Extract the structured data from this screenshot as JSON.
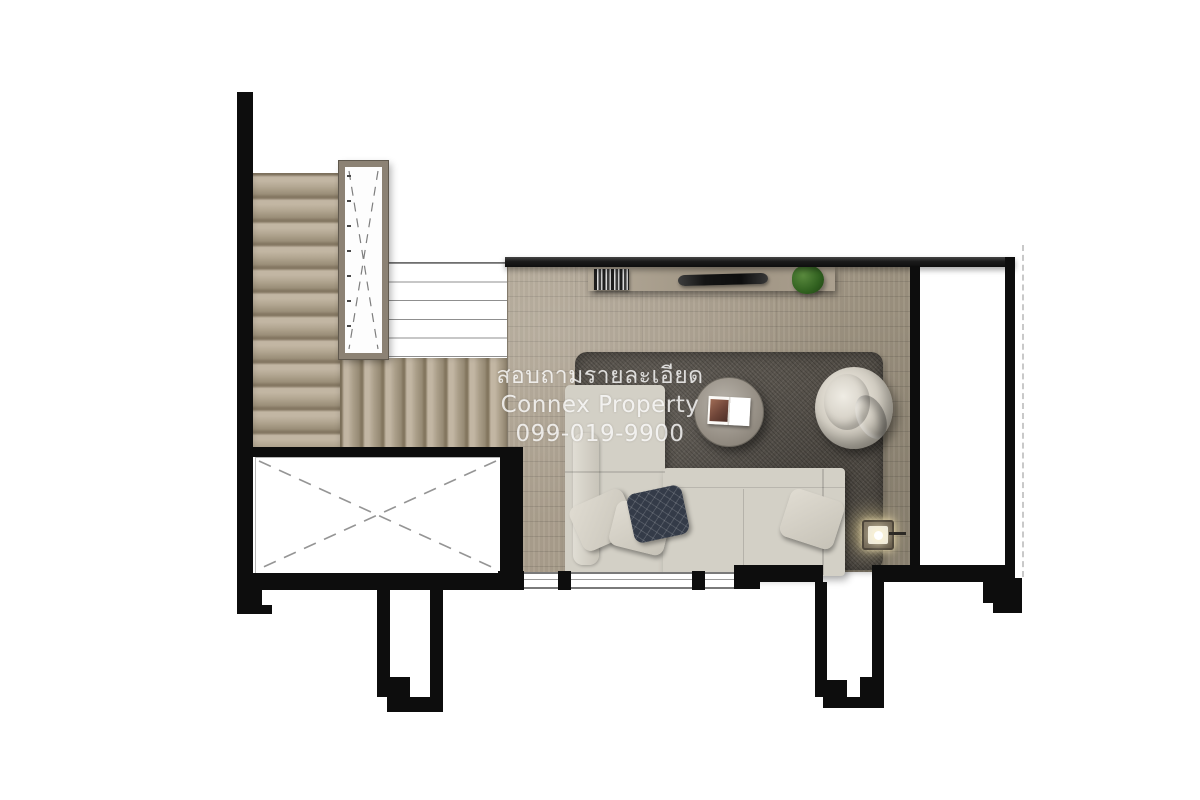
{
  "watermark": {
    "line1": "สอบถามรายละเอียด",
    "line2": "Connex Property",
    "line3": "099-019-9900"
  },
  "plan": {
    "kind": "top-down rendered floor plan (upper floor)",
    "areas": [
      {
        "name": "stair-hall",
        "features": [
          "staircase upper flight",
          "staircase lower flight",
          "stair shaft with dashed X",
          "railing"
        ]
      },
      {
        "name": "open-void",
        "features": [
          "dashed X opening"
        ]
      },
      {
        "name": "living-area",
        "features": [
          "wood plank floor",
          "window wall with two mullions",
          "two balcony recesses below wall"
        ]
      },
      {
        "name": "side-room",
        "features": [
          "empty room",
          "dashed property line at right"
        ]
      }
    ],
    "furniture": [
      "wall shelf with books",
      "tv-soundbar object on shelf",
      "potted plant on shelf",
      "gray shag rug",
      "l-shaped sectional sofa",
      "three light pillows and one dark quilted pillow",
      "round coffee table with open book",
      "round lounge armchair",
      "glowing floor lamp"
    ],
    "colors": {
      "wall": "#0d0d0d",
      "wood_floor": "#a69b89",
      "stair_wood": "#b3a690",
      "stair_frame": "#8c8274",
      "rug": "#56514a",
      "sofa": "#d3d0c6",
      "dark_pillow": "#343b48",
      "plant": "#3c6b2c",
      "lamp_glow": "#ffe9a0",
      "watermark_text": "#ffffff"
    }
  }
}
